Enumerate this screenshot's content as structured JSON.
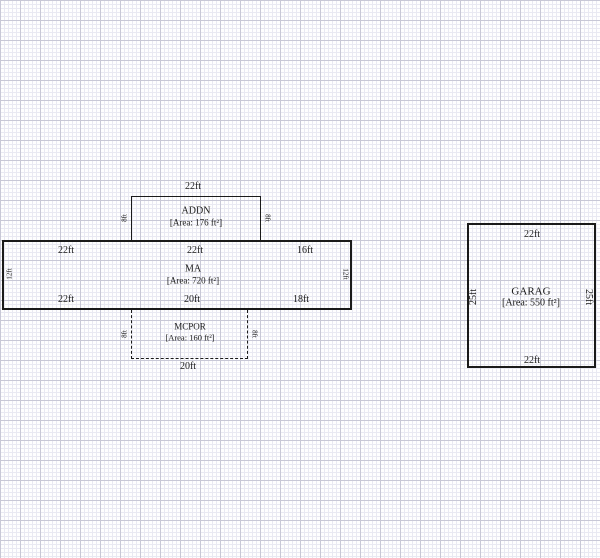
{
  "diagram": {
    "shapes": {
      "addn": {
        "name": "ADDN",
        "area": "[Area: 176 ft²]",
        "dim_top": "22ft",
        "dim_left": "8ft",
        "dim_right": "8ft"
      },
      "ma": {
        "name": "MA",
        "area": "[Area: 720 ft²]",
        "dims_top": [
          "22ft",
          "22ft",
          "16ft"
        ],
        "dims_bottom": [
          "22ft",
          "20ft",
          "18ft"
        ],
        "dim_left": "12ft",
        "dim_right": "12ft"
      },
      "mcpor": {
        "name": "MCPOR",
        "area": "[Area: 160 ft²]",
        "dim_bottom": "20ft",
        "dim_left": "8ft",
        "dim_right": "8ft"
      },
      "garag": {
        "name": "GARAG",
        "area": "[Area: 550 ft²]",
        "dim_top": "22ft",
        "dim_bottom": "22ft",
        "dim_left": "25ft",
        "dim_right": "25ft"
      }
    },
    "colors": {
      "line": "#1a1a1a",
      "grid_minor": "#e9e9f2",
      "grid_major": "#c8c8d6",
      "paper": "#fefefe"
    }
  }
}
